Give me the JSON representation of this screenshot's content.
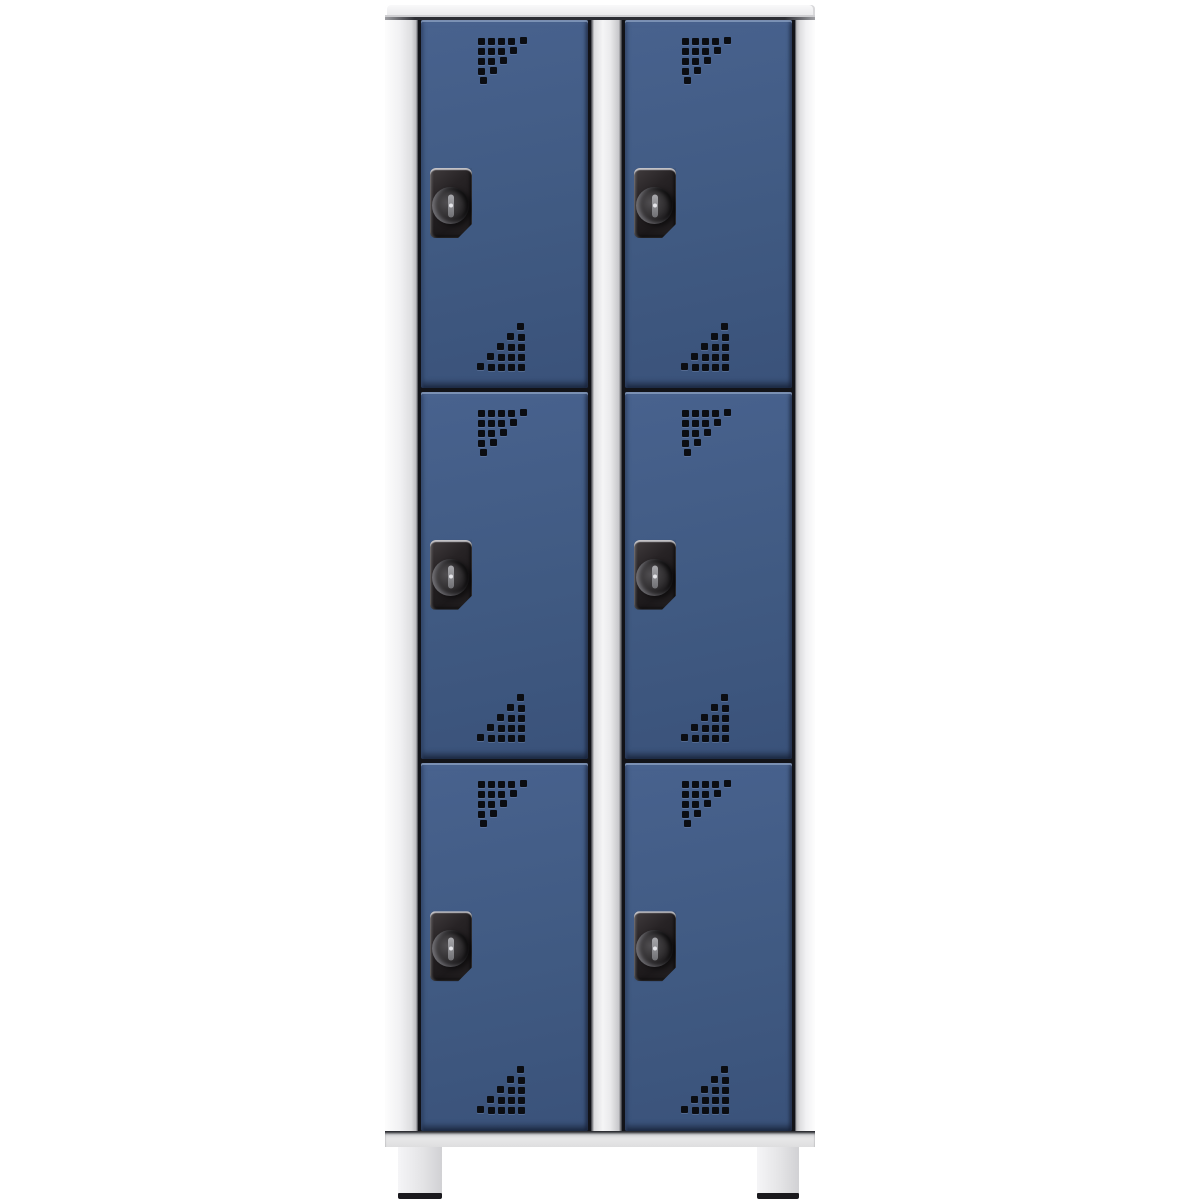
{
  "scene": {
    "description": "Product photograph of a six-compartment cloakroom locker on a white background",
    "background_color": "#ffffff"
  },
  "locker": {
    "columns": 2,
    "rows_per_column": 3,
    "total_compartments": 6,
    "legs_visible": 2,
    "frame_color": "#ececee",
    "door_color": "#3e5a84",
    "door_highlight_color": "#5f79a2",
    "door_edge_color": "#1c2b45",
    "seam_color": "#16171c",
    "divider_color": "#eeeeef",
    "foot_cap_color": "#1a191d",
    "doors": [
      {
        "id": "door-top-left",
        "column": "left",
        "row": 1
      },
      {
        "id": "door-middle-left",
        "column": "left",
        "row": 2
      },
      {
        "id": "door-bottom-left",
        "column": "left",
        "row": 3
      },
      {
        "id": "door-top-right",
        "column": "right",
        "row": 1
      },
      {
        "id": "door-middle-right",
        "column": "right",
        "row": 2
      },
      {
        "id": "door-bottom-right",
        "column": "right",
        "row": 3
      }
    ],
    "lock": {
      "type": "cylinder-cam-lock",
      "plate_color": "#221f21",
      "plate_width_px": 42,
      "plate_height_px": 70,
      "knob": "round-knob-with-vertical-key-slot",
      "slot_color": "#9a9a9e"
    },
    "perforation": {
      "hole_color": "#0b0d12",
      "hole_size_px": 7,
      "pitch_px": 10,
      "grid_rows": 5,
      "top_pattern": "stepped-triangle-descending-from-top-left",
      "bottom_pattern": "stepped-triangle-ascending-to-right"
    }
  }
}
